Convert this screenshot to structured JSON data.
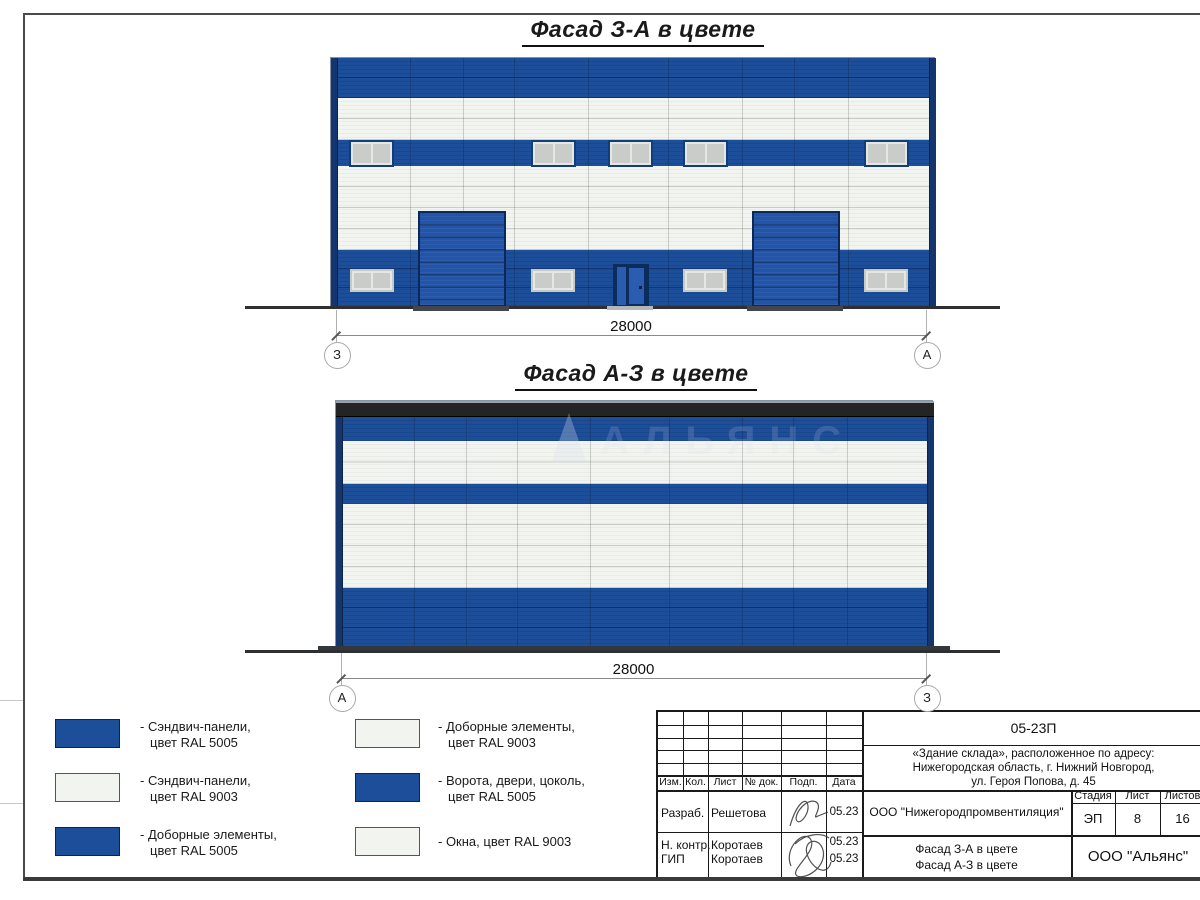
{
  "titles": {
    "facade1": "Фасад З-А в цвете",
    "facade2": "Фасад А-З в цвете"
  },
  "dimensions": {
    "facade1": {
      "label": "28000",
      "left_axis": "З",
      "right_axis": "А"
    },
    "facade2": {
      "label": "28000",
      "left_axis": "А",
      "right_axis": "З"
    }
  },
  "watermark": {
    "text": "АЛЬЯНС"
  },
  "colors": {
    "ral5005_blue": "#1d4e9a",
    "ral9003_white": "#f2f4f0",
    "trim_blue": "#15356d",
    "gate_blue": "#2254a8",
    "parapet_dark": "#242424"
  },
  "legend": {
    "items": [
      {
        "color": "#1d4e9a",
        "lines": [
          "- Сэндвич-панели,",
          "цвет RAL 5005"
        ]
      },
      {
        "color": "#f2f4f0",
        "lines": [
          "- Сэндвич-панели,",
          "цвет RAL 9003"
        ]
      },
      {
        "color": "#1d4e9a",
        "lines": [
          "- Доборные элементы,",
          "цвет RAL 5005"
        ]
      },
      {
        "color": "#f2f4f0",
        "lines": [
          "- Доборные элементы,",
          "цвет RAL 9003"
        ]
      },
      {
        "color": "#1d4e9a",
        "lines": [
          "- Ворота, двери, цоколь,",
          "цвет RAL 5005"
        ]
      },
      {
        "color": "#f2f4f0",
        "lines": [
          "- Окна, цвет RAL 9003"
        ]
      }
    ]
  },
  "title_block": {
    "doc_number": "05-23П",
    "project_lines": [
      "«Здание склада», расположенное по адресу:",
      "Нижегородская область, г. Нижний Новгород,",
      "ул. Героя Попова, д. 45"
    ],
    "columns": [
      "Изм.",
      "Кол.",
      "Лист",
      "№ док.",
      "Подп.",
      "Дата"
    ],
    "rows": [
      {
        "role": "Разраб.",
        "name": "Решетова",
        "date": "05.23"
      },
      {
        "role": "Н. контр.",
        "name": "Коротаев",
        "date": "05.23"
      },
      {
        "role": "ГИП",
        "name": "Коротаев",
        "date": "05.23"
      }
    ],
    "organization": "ООО \"Нижегородпромвентиляция\"",
    "stage_header": [
      "Стадия",
      "Лист",
      "Листов"
    ],
    "stage_values": [
      "ЭП",
      "8",
      "16"
    ],
    "sheet_title_lines": [
      "Фасад З-А в цвете",
      "Фасад А-З в цвете"
    ],
    "company": "ООО \"Альянс\""
  }
}
